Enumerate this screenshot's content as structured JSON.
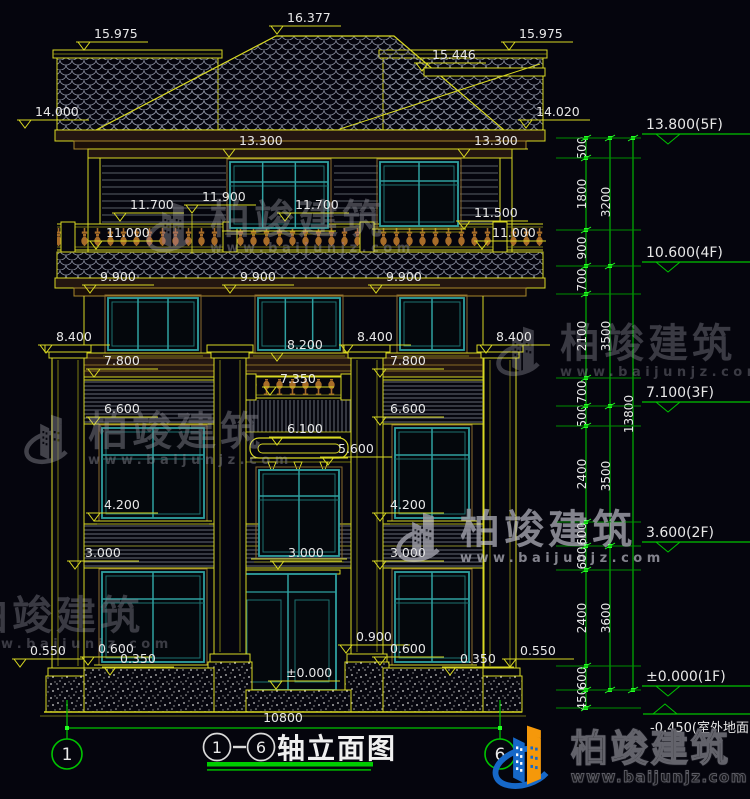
{
  "drawing": {
    "title": {
      "axis_start": "1",
      "dash": "-",
      "axis_end": "6",
      "label": "轴立面图"
    },
    "bottom_dim": "10800",
    "grid_bubbles": [
      "1",
      "6"
    ],
    "elevation_marks": [
      {
        "v": "15.975",
        "x": 94,
        "lv": 51
      },
      {
        "v": "16.377",
        "x": 287,
        "lv": 35
      },
      {
        "v": "15.446",
        "x": 432,
        "lv": 72
      },
      {
        "v": "15.975",
        "x": 519,
        "lv": 51
      },
      {
        "v": "14.000",
        "x": 35,
        "lv": 129
      },
      {
        "v": "14.020",
        "x": 536,
        "lv": 129
      },
      {
        "v": "13.300",
        "x": 239,
        "lv": 158
      },
      {
        "v": "13.300",
        "x": 474,
        "lv": 158
      },
      {
        "v": "11.900",
        "x": 202,
        "lv": 214
      },
      {
        "v": "11.700",
        "x": 130,
        "lv": 222
      },
      {
        "v": "11.700",
        "x": 295,
        "lv": 222
      },
      {
        "v": "11.500",
        "x": 474,
        "lv": 230
      },
      {
        "v": "11.000",
        "x": 106,
        "lv": 250
      },
      {
        "v": "11.000",
        "x": 492,
        "lv": 250
      },
      {
        "v": "9.900",
        "x": 100,
        "lv": 294
      },
      {
        "v": "9.900",
        "x": 240,
        "lv": 294
      },
      {
        "v": "9.900",
        "x": 386,
        "lv": 294
      },
      {
        "v": "8.400",
        "x": 56,
        "lv": 354
      },
      {
        "v": "8.400",
        "x": 357,
        "lv": 354
      },
      {
        "v": "8.400",
        "x": 496,
        "lv": 354
      },
      {
        "v": "8.200",
        "x": 287,
        "lv": 362
      },
      {
        "v": "7.800",
        "x": 104,
        "lv": 378
      },
      {
        "v": "7.800",
        "x": 390,
        "lv": 378
      },
      {
        "v": "7.350",
        "x": 280,
        "lv": 396
      },
      {
        "v": "6.600",
        "x": 104,
        "lv": 426
      },
      {
        "v": "6.600",
        "x": 390,
        "lv": 426
      },
      {
        "v": "6.100",
        "x": 287,
        "lv": 446
      },
      {
        "v": "5.600",
        "x": 338,
        "lv": 466
      },
      {
        "v": "4.200",
        "x": 104,
        "lv": 522
      },
      {
        "v": "4.200",
        "x": 390,
        "lv": 522
      },
      {
        "v": "3.000",
        "x": 85,
        "lv": 570
      },
      {
        "v": "3.000",
        "x": 288,
        "lv": 570
      },
      {
        "v": "3.000",
        "x": 390,
        "lv": 570
      },
      {
        "v": "0.900",
        "x": 356,
        "lv": 654
      },
      {
        "v": "0.600",
        "x": 98,
        "lv": 666
      },
      {
        "v": "0.600",
        "x": 390,
        "lv": 666
      },
      {
        "v": "0.550",
        "x": 30,
        "lv": 668
      },
      {
        "v": "0.550",
        "x": 520,
        "lv": 668
      },
      {
        "v": "0.350",
        "x": 120,
        "lv": 676
      },
      {
        "v": "0.350",
        "x": 460,
        "lv": 676
      },
      {
        "v": "±0.000",
        "x": 286,
        "lv": 690
      }
    ],
    "level_markers": [
      {
        "v": "13.800(5F)",
        "lv": 138
      },
      {
        "v": "10.600(4F)",
        "lv": 266
      },
      {
        "v": "7.100(3F)",
        "lv": 406
      },
      {
        "v": "3.600(2F)",
        "lv": 546
      },
      {
        "v": "±0.000(1F)",
        "lv": 690
      },
      {
        "v": "-0.450(室外地面)",
        "lv": 708,
        "flip": true
      }
    ],
    "dim_chains": [
      {
        "x": 586,
        "segs": [
          {
            "v": "500",
            "y1": 138,
            "y2": 158
          },
          {
            "v": "1800",
            "y1": 158,
            "y2": 230
          },
          {
            "v": "900",
            "y1": 230,
            "y2": 266
          },
          {
            "v": "700",
            "y1": 266,
            "y2": 294
          },
          {
            "v": "2100",
            "y1": 294,
            "y2": 378
          },
          {
            "v": "700",
            "y1": 378,
            "y2": 406
          },
          {
            "v": "500",
            "y1": 406,
            "y2": 426
          },
          {
            "v": "2400",
            "y1": 426,
            "y2": 522
          },
          {
            "v": "600",
            "y1": 522,
            "y2": 546
          },
          {
            "v": "600",
            "y1": 546,
            "y2": 570
          },
          {
            "v": "2400",
            "y1": 570,
            "y2": 666
          },
          {
            "v": "600",
            "y1": 666,
            "y2": 690
          },
          {
            "v": "450",
            "y1": 690,
            "y2": 708
          }
        ]
      },
      {
        "x": 610,
        "segs": [
          {
            "v": "3200",
            "y1": 138,
            "y2": 266
          },
          {
            "v": "3500",
            "y1": 266,
            "y2": 406
          },
          {
            "v": "3500",
            "y1": 406,
            "y2": 546
          },
          {
            "v": "3600",
            "y1": 546,
            "y2": 690
          }
        ]
      },
      {
        "x": 633,
        "segs": [
          {
            "v": "13800",
            "y1": 138,
            "y2": 690
          }
        ]
      }
    ]
  },
  "watermark": {
    "name": "柏竣建筑",
    "url": "www.baijunjz.com",
    "instances": [
      {
        "x": 146,
        "y": 196,
        "op": 0.55,
        "color": "#74747e"
      },
      {
        "x": 496,
        "y": 320,
        "op": 0.5,
        "color": "#70707a"
      },
      {
        "x": 24,
        "y": 408,
        "op": 0.55,
        "color": "#74747e"
      },
      {
        "x": 396,
        "y": 506,
        "op": 0.85,
        "color": "#9a9aa4"
      },
      {
        "x": -96,
        "y": 592,
        "op": 0.5,
        "color": "#70707a"
      }
    ]
  },
  "footer_logo": {
    "name": "柏竣建筑",
    "url": "www.baijunjz.com"
  },
  "colors": {
    "background": "#05050d",
    "line_yellow": "#d8d822",
    "dim_green": "#00c400",
    "glass_teal": "#2fa0a0",
    "text_white": "#e8e8e8",
    "fascia_brown": "#241610",
    "baluster_brown": "#a86c28",
    "tile_gray": "#8d93a3",
    "watermark_gray": "#80808a",
    "logo_blue": "#1668c8",
    "logo_orange": "#f5980a"
  }
}
